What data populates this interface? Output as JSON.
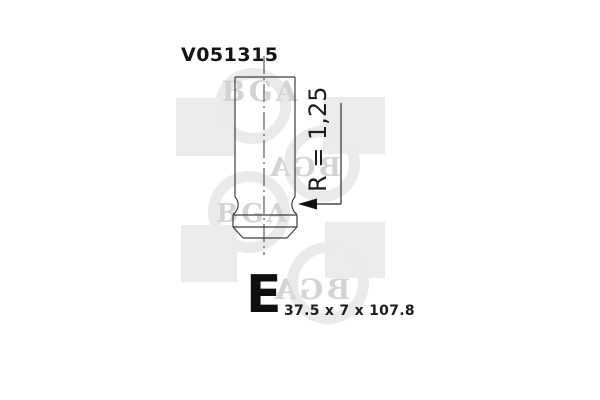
{
  "part": {
    "number": "V051315"
  },
  "valve": {
    "radius_annotation": "R = 1,25",
    "type_letter": "E",
    "dimensions": "37.5 x 7 x 107.8"
  },
  "watermark": {
    "brand": "BGA"
  },
  "colors": {
    "background": "#ffffff",
    "drawing_line": "#3d3d3d",
    "annotation_arrow": "#111111",
    "label_text": "#141414",
    "watermark_shape": "#ebebeb",
    "watermark_text": "#d4d4d4"
  }
}
